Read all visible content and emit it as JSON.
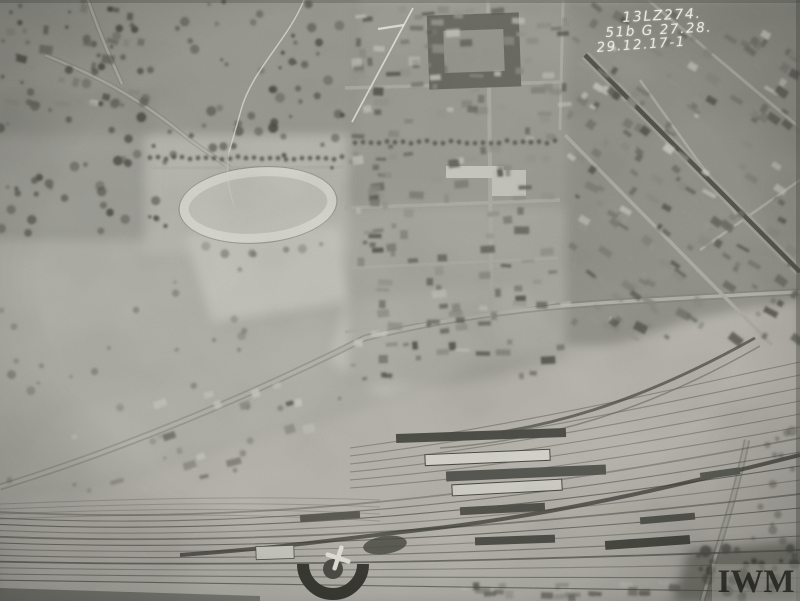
{
  "photo": {
    "annotation": {
      "line1": "13LZ274.",
      "line2": "51b G 27.28.",
      "line3": "29.12.17-1"
    },
    "watermark": {
      "text": "IWM"
    },
    "colors": {
      "paper_light": "#c6c6be",
      "ground_mid": "#b4b4ac",
      "shadow_dark": "#3e3e38",
      "annotation_ink": "#eaeae2",
      "watermark_ink": "#1c1c1a"
    }
  }
}
